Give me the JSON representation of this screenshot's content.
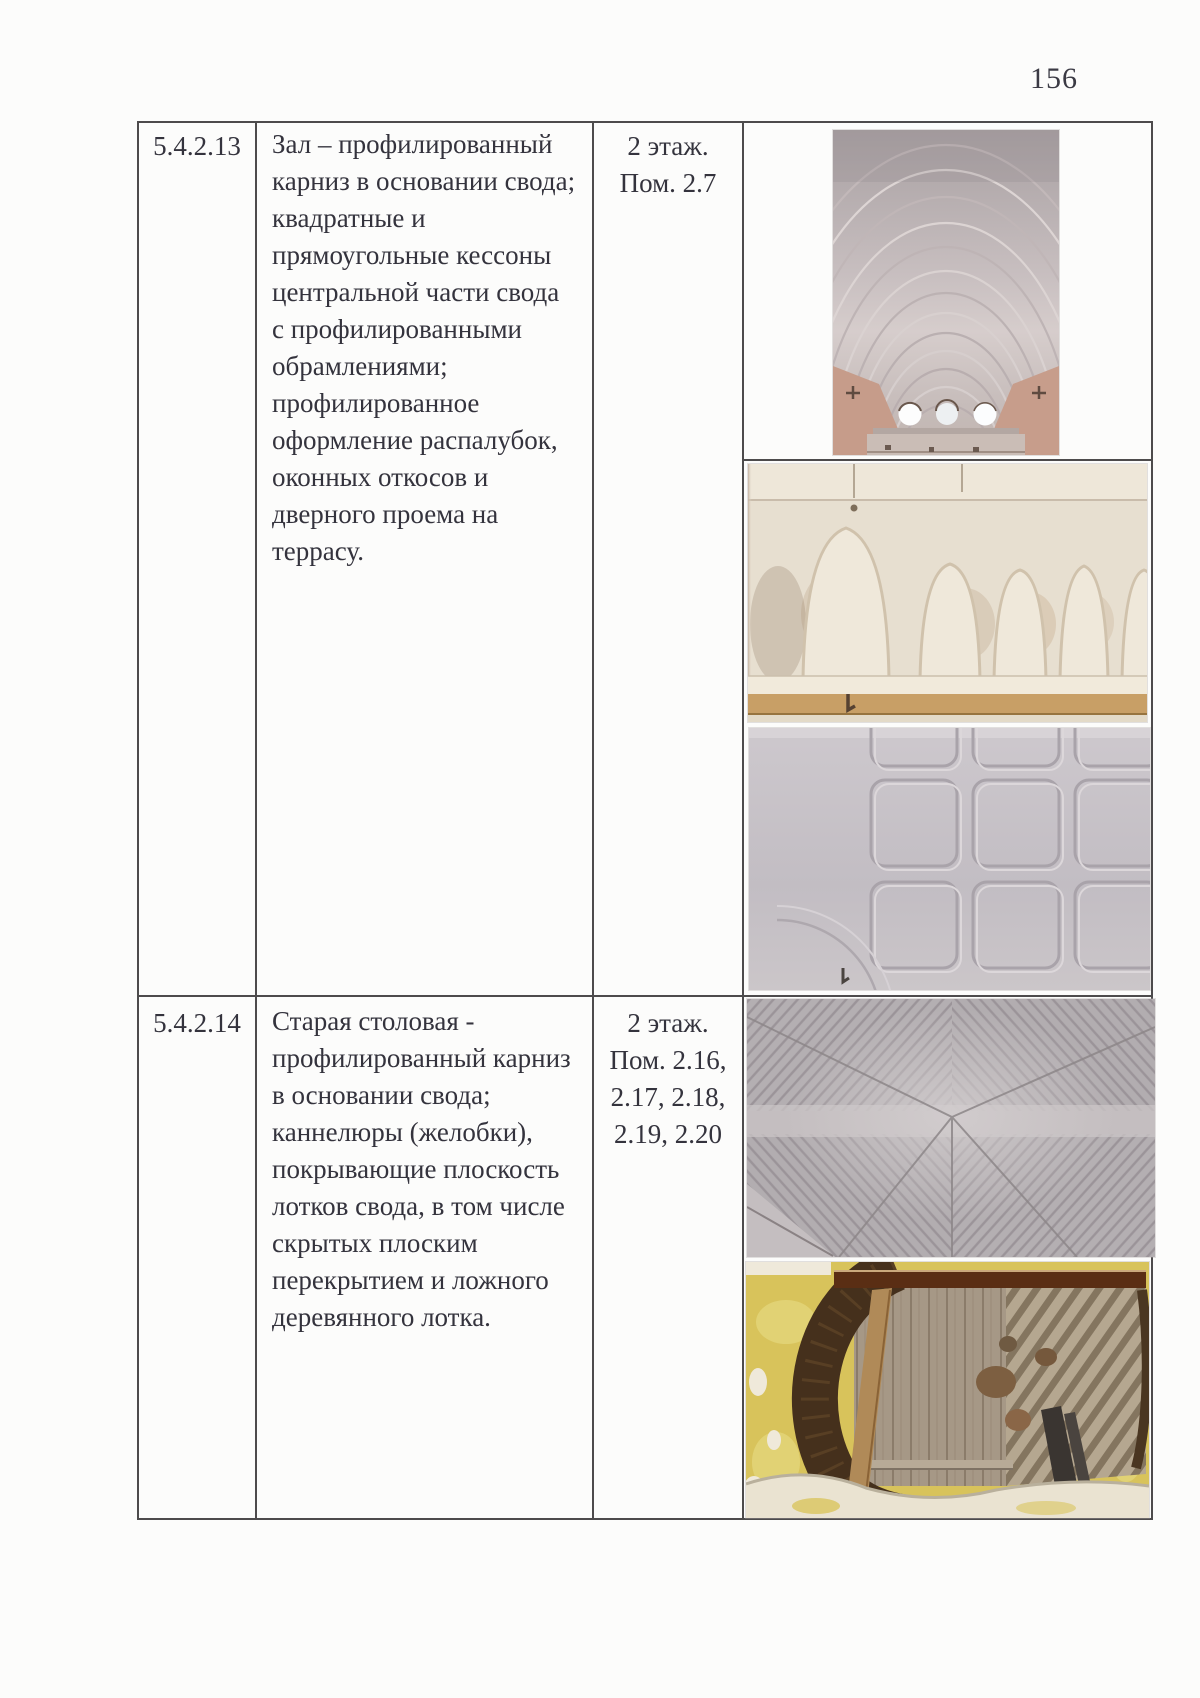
{
  "page": {
    "number": "156"
  },
  "table": {
    "rows": [
      {
        "id": "5.4.2.13",
        "description_lines": [
          "Зал – профилированный",
          "карниз в основании свода;",
          "квадратные и",
          "прямоугольные кессоны",
          "центральной части свода",
          "с профилированными",
          "обрамлениями;",
          "профилированное",
          "оформление распалубок,",
          "оконных откосов и",
          "дверного проема на",
          "террасу."
        ],
        "location_lines": [
          "2 этаж.",
          "Пом. 2.7"
        ],
        "photos": [
          "photo-vaulted-hall-ceiling",
          "photo-vault-lunettes",
          "photo-coffered-ceiling-grid"
        ]
      },
      {
        "id": "5.4.2.14",
        "description_lines": [
          "Старая столовая -",
          "профилированный карниз",
          "в основании свода;",
          "каннелюры (желобки),",
          "покрывающие плоскость",
          "лотков свода, в том числе",
          "скрытых плоским",
          "перекрытием и ложного",
          "деревянного лотка."
        ],
        "location_lines": [
          "2 этаж.",
          "Пом. 2.16,",
          "2.17, 2.18,",
          "2.19, 2.20"
        ],
        "photos": [
          "photo-fluted-vault",
          "photo-exposed-ceiling-structure"
        ]
      }
    ]
  },
  "colors": {
    "border": "#4d4b4c",
    "text": "#34333d",
    "plaster_cream": "#e8e0d2",
    "plaster_grey": "#c3bec3",
    "plaster_pink": "#c69c8a",
    "ochre_yellow": "#d8c35b",
    "wood_dark": "#45301c"
  }
}
